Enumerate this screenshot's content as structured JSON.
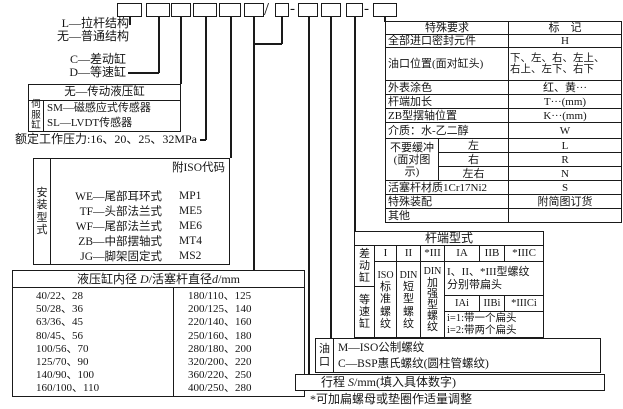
{
  "separators": {
    "slash": "/",
    "dash": "-"
  },
  "labels": {
    "l_structure": "L—拉杆结构",
    "none_structure": "无—普通结构",
    "c_cylinder": "C—差动缸",
    "d_cylinder": "D—等速缸",
    "pressure": "额定工作压力:16、20、25、32MPa"
  },
  "servo": {
    "row_top": "无—传动液压缸",
    "side": "伺服缸",
    "rows": [
      "SM—磁感应式传感器",
      "SL—LVDT传感器"
    ]
  },
  "mounting": {
    "side": "安装型式",
    "note": "附ISO代码",
    "rows": [
      {
        "code": "WE—尾部耳环式",
        "iso": "MP1"
      },
      {
        "code": "TF—头部法兰式",
        "iso": "ME5"
      },
      {
        "code": "WF—尾部法兰式",
        "iso": "ME6"
      },
      {
        "code": "ZB—中部摆轴式",
        "iso": "MT4"
      },
      {
        "code": "JG—脚架固定式",
        "iso": "MS2"
      }
    ]
  },
  "bore": {
    "title": [
      "液压缸内径 ",
      "D",
      "/活塞杆直径",
      "d",
      "/mm"
    ],
    "left": [
      "40/22、28",
      "50/28、36",
      "63/36、45",
      "80/45、56",
      "100/56、70",
      "125/70、90",
      "140/90、100",
      "160/100、110"
    ],
    "right": [
      "180/110、125",
      "200/125、140",
      "220/140、160",
      "250/160、180",
      "280/180、200",
      "320/200、220",
      "360/220、250",
      "400/250、280"
    ]
  },
  "special": {
    "header": {
      "name": "特殊要求",
      "mark": "标　记"
    },
    "seal": {
      "name": "全部进口密封元件",
      "mark": "H"
    },
    "port_pos": {
      "name": "油口位置(面对缸头)",
      "mark1": "下、左、右、左上、",
      "mark2": "右上、左下、右下"
    },
    "paint": {
      "name": "外表涂色",
      "mark": "红、黄···"
    },
    "rod_ext": {
      "name": "杆端加长",
      "mark": "T···(mm)"
    },
    "zb_pos": {
      "name": "ZB型摆轴位置",
      "mark": "K···(mm)"
    },
    "medium": {
      "name": "介质：水-乙二醇",
      "mark": "W"
    },
    "cushion": {
      "line1": "不要缓冲",
      "line2": "(面对图示)",
      "opts": [
        {
          "pos": "左",
          "mark": "L"
        },
        {
          "pos": "右",
          "mark": "R"
        },
        {
          "pos": "左右",
          "mark": "N"
        }
      ]
    },
    "rod_material": {
      "name": "活塞杆材质1Cr17Ni2",
      "mark": "S"
    },
    "assembly": {
      "name": "特殊装配",
      "mark": "附简图订货"
    },
    "other": {
      "name": "其他",
      "mark": ""
    }
  },
  "rod_end": {
    "title": "杆端型式",
    "side_top": "差动缸",
    "side_bottom": "等速缸",
    "heads": [
      "I",
      "II",
      "*III"
    ],
    "cols": [
      {
        "head": "ISO",
        "body": "标准螺纹"
      },
      {
        "head": "DIN",
        "body": "短型螺纹"
      },
      {
        "head": "DIN",
        "body": "加强型螺纹"
      }
    ],
    "right_heads": [
      "IA",
      "IIB",
      "*IIIC"
    ],
    "note1": [
      "I、II、*III型螺纹",
      "分别带扁头"
    ],
    "subheads": [
      "IAi",
      "IIBi",
      "*IIICi"
    ],
    "note2": [
      "i=1:带一个扁头",
      "i=2:带两个扁头"
    ]
  },
  "port": {
    "side": "油口",
    "rows": [
      "M—ISO公制螺纹",
      "C—BSP惠氏螺纹(圆柱管螺纹)"
    ]
  },
  "stroke": [
    "行程 ",
    "S",
    "/mm(填入具体数字)"
  ],
  "footnote": "*可加扁螺母或垫圈作适量调整"
}
